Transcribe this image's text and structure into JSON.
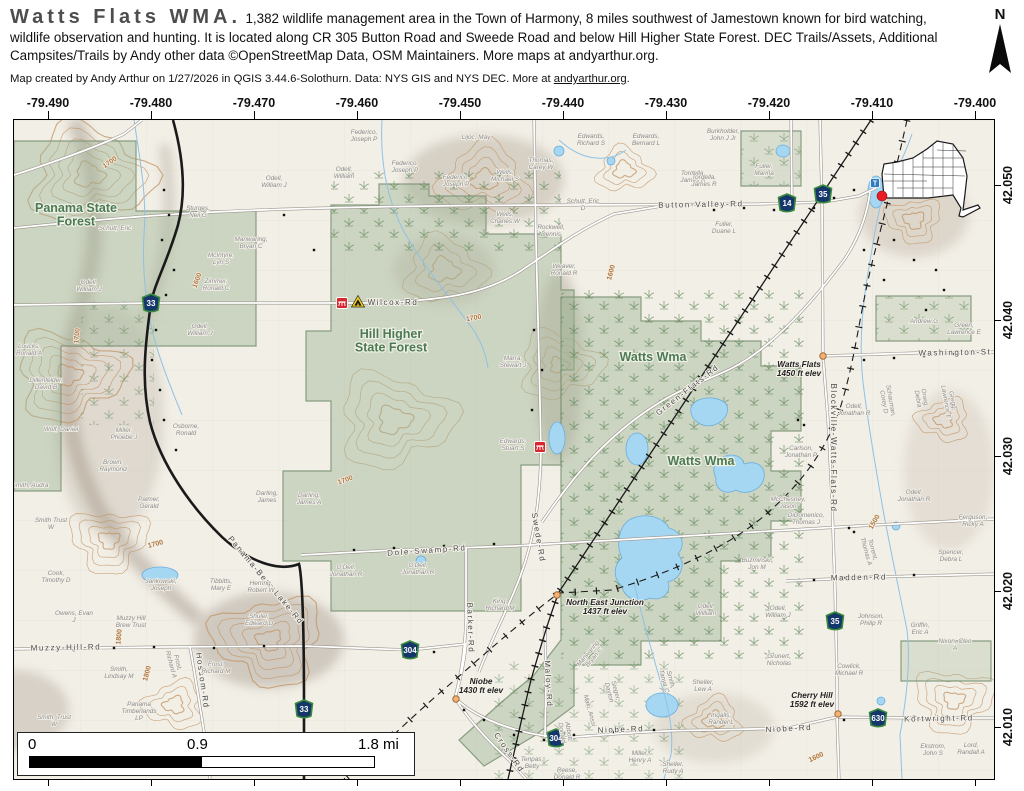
{
  "header": {
    "title": "Watts Flats WMA.",
    "description": "1,382 wildlife management area in the Town of Harmony, 8 miles southwest of Jamestown known for bird watching, wildlife observation and hunting. It is located along CR 305 Button Road and Sweede Road and below Hill Higher State Forest. DEC Trails/Assets, Additional Campsites/Trails by Andy other data ©OpenStreetMap Data, OSM Maintainers. More maps at andyarthur.org.",
    "attribution_prefix": "Map created by Andy Arthur on 1/27/2026 in QGIS 3.44.6-Solothurn. Data: NYS GIS and NYS DEC. More at ",
    "attribution_link": "andyarthur.org",
    "attribution_suffix": ".",
    "north_label": "N"
  },
  "axes": {
    "lon": [
      "-79.490",
      "-79.480",
      "-79.470",
      "-79.460",
      "-79.450",
      "-79.440",
      "-79.430",
      "-79.420",
      "-79.410",
      "-79.400"
    ],
    "lon_x": [
      35,
      138,
      241,
      344,
      447,
      550,
      653,
      756,
      859,
      962
    ],
    "lat": [
      "42.050",
      "42.040",
      "42.030",
      "42.020",
      "42.010"
    ],
    "lat_y": [
      185,
      320,
      456,
      591,
      727
    ]
  },
  "scalebar": {
    "start": "0",
    "mid": "0.9",
    "end": "1.8 mi"
  },
  "colors": {
    "forest_green": "#9db395",
    "water": "#a6d7f2",
    "contour": "#c0905f",
    "shield_fill": "#15366b",
    "shield_border": "#3a8a3c",
    "parking_red": "#d7272e",
    "campsite_yellow": "#f7d117",
    "trailhead_blue": "#2e7bbf",
    "locator_red": "#ea1c24"
  },
  "map": {
    "area_labels": [
      {
        "t": "Panama State\nForest",
        "x": 62,
        "y": 92
      },
      {
        "t": "Hill Higher\nState Forest",
        "x": 377,
        "y": 218
      },
      {
        "t": "Watts Wma",
        "x": 639,
        "y": 241
      },
      {
        "t": "Watts Wma",
        "x": 687,
        "y": 345
      }
    ],
    "road_labels": [
      {
        "t": "Wilcox-Rd",
        "x": 379,
        "y": 185,
        "r": 0
      },
      {
        "t": "Button-Valley-Rd",
        "x": 687,
        "y": 87,
        "r": -1
      },
      {
        "t": "Washington-St",
        "x": 941,
        "y": 235,
        "r": -1
      },
      {
        "t": "Green-Flats-Rd",
        "x": 675,
        "y": 272,
        "r": -38
      },
      {
        "t": "Dole-Swamp-Rd",
        "x": 413,
        "y": 433,
        "r": -4
      },
      {
        "t": "Muzzy-Hill-Rd",
        "x": 52,
        "y": 530,
        "r": -1
      },
      {
        "t": "Hossom-Rd",
        "x": 186,
        "y": 561,
        "r": 82
      },
      {
        "t": "Panama-Bear-Lake-Rd",
        "x": 250,
        "y": 462,
        "r": 50
      },
      {
        "t": "Barker-Rd",
        "x": 454,
        "y": 508,
        "r": 88
      },
      {
        "t": "Maloy-Rd",
        "x": 532,
        "y": 564,
        "r": 87
      },
      {
        "t": "Cross-Rd",
        "x": 493,
        "y": 634,
        "r": 55
      },
      {
        "t": "Swede-Rd",
        "x": 522,
        "y": 418,
        "r": 80
      },
      {
        "t": "Blockville-Watts-Flats-Rd",
        "x": 817,
        "y": 328,
        "r": 90
      },
      {
        "t": "Madden-Rd",
        "x": 845,
        "y": 460,
        "r": -1
      },
      {
        "t": "Niobe-Rd",
        "x": 607,
        "y": 612,
        "r": -2
      },
      {
        "t": "Niobe-Rd",
        "x": 775,
        "y": 611,
        "r": -3
      },
      {
        "t": "Kortwright-Rd",
        "x": 925,
        "y": 601,
        "r": -1
      }
    ],
    "contour_labels": [
      {
        "t": "1700",
        "x": 97,
        "y": 44,
        "r": -35
      },
      {
        "t": "1700",
        "x": 65,
        "y": 216,
        "r": -85
      },
      {
        "t": "1600",
        "x": 185,
        "y": 161,
        "r": -70
      },
      {
        "t": "1700",
        "x": 142,
        "y": 426,
        "r": -15
      },
      {
        "t": "1800",
        "x": 107,
        "y": 517,
        "r": -85
      },
      {
        "t": "1800",
        "x": 135,
        "y": 554,
        "r": -75
      },
      {
        "t": "1700",
        "x": 332,
        "y": 362,
        "r": -20
      },
      {
        "t": "1700",
        "x": 460,
        "y": 200,
        "r": -10
      },
      {
        "t": "1600",
        "x": 599,
        "y": 153,
        "r": -75
      },
      {
        "t": "1500",
        "x": 862,
        "y": 403,
        "r": -60
      },
      {
        "t": "1600",
        "x": 803,
        "y": 639,
        "r": -25
      }
    ],
    "elev_points": [
      {
        "t": "Watts Flats\n1450 ft elev",
        "x": 785,
        "y": 247,
        "cx": 809,
        "cy": 236
      },
      {
        "t": "North East Junction\n1437 ft elev",
        "x": 591,
        "y": 485,
        "cx": 543,
        "cy": 475
      },
      {
        "t": "Niobe\n1430 ft elev",
        "x": 467,
        "y": 564,
        "cx": 442,
        "cy": 579
      },
      {
        "t": "Cherry Hill\n1592 ft elev",
        "x": 798,
        "y": 578,
        "cx": 824,
        "cy": 594
      }
    ],
    "shields": [
      {
        "n": "33",
        "x": 137,
        "y": 183
      },
      {
        "n": "33",
        "x": 290,
        "y": 589
      },
      {
        "n": "14",
        "x": 773,
        "y": 83
      },
      {
        "n": "35",
        "x": 809,
        "y": 74
      },
      {
        "n": "35",
        "x": 821,
        "y": 501
      },
      {
        "n": "304",
        "x": 396,
        "y": 530
      },
      {
        "n": "304",
        "x": 542,
        "y": 618
      },
      {
        "n": "630",
        "x": 864,
        "y": 598
      }
    ],
    "icons": [
      {
        "type": "parking",
        "x": 328,
        "y": 183
      },
      {
        "type": "campsite",
        "x": 344,
        "y": 182
      },
      {
        "type": "parking",
        "x": 526,
        "y": 327
      },
      {
        "type": "trailhead",
        "x": 861,
        "y": 63
      },
      {
        "type": "locator-dot",
        "x": 868,
        "y": 76
      }
    ],
    "parcel_labels": [
      {
        "t": "Federico,\nJoseph P",
        "x": 350,
        "y": 14
      },
      {
        "t": "Federico,\nJoseph P",
        "x": 391,
        "y": 45
      },
      {
        "t": "Federico,\nJoseph P",
        "x": 442,
        "y": 59
      },
      {
        "t": "Lijoc, May",
        "x": 462,
        "y": 19
      },
      {
        "t": "Wells,\nMichael S",
        "x": 491,
        "y": 54
      },
      {
        "t": "Wells,\nCharles W",
        "x": 491,
        "y": 96
      },
      {
        "t": "Odell,\nWilliam",
        "x": 330,
        "y": 51
      },
      {
        "t": "Odell,\nWilliam J",
        "x": 260,
        "y": 60
      },
      {
        "t": "Sturges,\nNeil G",
        "x": 184,
        "y": 90
      },
      {
        "t": "Manwaring,\nBryan C",
        "x": 237,
        "y": 121
      },
      {
        "t": "McIntyre,\nLyn S",
        "x": 207,
        "y": 137
      },
      {
        "t": "Zimmer,\nRonald C",
        "x": 202,
        "y": 163
      },
      {
        "t": "Odell,\nWilliam J",
        "x": 186,
        "y": 208
      },
      {
        "t": "Odell,\nWilliam J",
        "x": 75,
        "y": 164
      },
      {
        "t": "Loucks,\nRonald A",
        "x": 15,
        "y": 228
      },
      {
        "t": "Dillenfelder,\nDavid B",
        "x": 32,
        "y": 262
      },
      {
        "t": "Wolf, Daniel",
        "x": 47,
        "y": 311
      },
      {
        "t": "Miller,\nPhoebe J",
        "x": 110,
        "y": 312
      },
      {
        "t": "Osborne,\nRonald",
        "x": 172,
        "y": 308
      },
      {
        "t": "Brown,\nRaymond",
        "x": 99,
        "y": 344
      },
      {
        "t": "Palmer,\nGerald",
        "x": 135,
        "y": 381
      },
      {
        "t": "Smith, Audra",
        "x": 16,
        "y": 367
      },
      {
        "t": "Smith Trust\nW",
        "x": 37,
        "y": 402
      },
      {
        "t": "Cook,\nTimothy D",
        "x": 42,
        "y": 455
      },
      {
        "t": "Owens, Evan\nJ",
        "x": 60,
        "y": 495
      },
      {
        "t": "Smith,\nLindsay M",
        "x": 105,
        "y": 551
      },
      {
        "t": "Panama\nTimberlands\nLP",
        "x": 125,
        "y": 586
      },
      {
        "t": "Smith, Trust\nW",
        "x": 40,
        "y": 599
      },
      {
        "t": "Muzzy Hill\nBrew Trust",
        "x": 117,
        "y": 500
      },
      {
        "t": "Jankowski,\nJoseph",
        "x": 147,
        "y": 463
      },
      {
        "t": "Tibbitts,\nMary E",
        "x": 207,
        "y": 463
      },
      {
        "t": "Herring,\nRobert W",
        "x": 247,
        "y": 465
      },
      {
        "t": "Shuler,\nEdward D",
        "x": 245,
        "y": 498
      },
      {
        "t": "Frost,\nRichard A",
        "x": 162,
        "y": 543,
        "r": 75
      },
      {
        "t": "Frost,\nRichard M",
        "x": 202,
        "y": 546
      },
      {
        "t": "Darling,\nJames",
        "x": 253,
        "y": 375
      },
      {
        "t": "Darling,\nJames A",
        "x": 295,
        "y": 377
      },
      {
        "t": "O'Dell,\nJonathan R",
        "x": 332,
        "y": 449
      },
      {
        "t": "O'Dell,\nJonathan R",
        "x": 404,
        "y": 447
      },
      {
        "t": "King,\nRichard M",
        "x": 486,
        "y": 483
      },
      {
        "t": "Marra,\nStewart J",
        "x": 499,
        "y": 240
      },
      {
        "t": "Edwards,\nStuart S",
        "x": 499,
        "y": 323
      },
      {
        "t": "Thomas,\nCarey W",
        "x": 527,
        "y": 42
      },
      {
        "t": "Rockwell,\nDennis",
        "x": 537,
        "y": 109
      },
      {
        "t": "Schutt, Eric\nD",
        "x": 569,
        "y": 83
      },
      {
        "t": "Weaver,\nRonald R",
        "x": 550,
        "y": 148
      },
      {
        "t": "Edwards,\nRichard S",
        "x": 577,
        "y": 18
      },
      {
        "t": "Edwards,\nBernard L",
        "x": 632,
        "y": 18
      },
      {
        "t": "Tordella,\nJames R",
        "x": 679,
        "y": 55
      },
      {
        "t": "Burkholder,\nJohn J Jr",
        "x": 709,
        "y": 13
      },
      {
        "t": "Fuller,\nMarina",
        "x": 750,
        "y": 48
      },
      {
        "t": "Fuller,\nDuane L",
        "x": 710,
        "y": 106
      },
      {
        "t": "Carlson,\nJonathan P",
        "x": 787,
        "y": 330
      },
      {
        "t": "McChesney,\nJason",
        "x": 774,
        "y": 381
      },
      {
        "t": "DiDomenico,\nThomas J",
        "x": 792,
        "y": 397
      },
      {
        "t": "Buzminski,\nJon M",
        "x": 743,
        "y": 442
      },
      {
        "t": "Odell,\nWilliam",
        "x": 692,
        "y": 488
      },
      {
        "t": "Odell,\nWilliam J",
        "x": 764,
        "y": 490
      },
      {
        "t": "Grunert,\nNicholas",
        "x": 765,
        "y": 538
      },
      {
        "t": "Manwaring,\nBryan C",
        "x": 576,
        "y": 534,
        "r": -50
      },
      {
        "t": "Smith,\nTanya C",
        "x": 655,
        "y": 560,
        "r": 75
      },
      {
        "t": "Sheller,\nLew A",
        "x": 689,
        "y": 564
      },
      {
        "t": "Ingalls,\nRandel L",
        "x": 707,
        "y": 597
      },
      {
        "t": "Maki, Anssi",
        "x": 574,
        "y": 591,
        "r": 75
      },
      {
        "t": "Sieger,\nDayton",
        "x": 600,
        "y": 571,
        "r": 75
      },
      {
        "t": "Abbott,\nDonald",
        "x": 553,
        "y": 612,
        "r": 80
      },
      {
        "t": "Tenpas,\nBetty",
        "x": 518,
        "y": 641
      },
      {
        "t": "Miller,\nHenry A",
        "x": 626,
        "y": 635
      },
      {
        "t": "Sheller,\nRudy A",
        "x": 659,
        "y": 646
      },
      {
        "t": "Reese,\nDonald R",
        "x": 553,
        "y": 652
      },
      {
        "t": "Johnson,\nPhilip R",
        "x": 857,
        "y": 498
      },
      {
        "t": "Griffin,\nEric A",
        "x": 906,
        "y": 507
      },
      {
        "t": "Nixon, Cleo\nA",
        "x": 941,
        "y": 523
      },
      {
        "t": "Cowlick,\nMichael R",
        "x": 835,
        "y": 548
      },
      {
        "t": "Ekstrom,\nJohn S",
        "x": 919,
        "y": 628
      },
      {
        "t": "Lord,\nRandall A",
        "x": 957,
        "y": 627
      },
      {
        "t": "Odell,\nJonathan R",
        "x": 840,
        "y": 288
      },
      {
        "t": "Odell,\nJonathan R",
        "x": 900,
        "y": 374
      },
      {
        "t": "Schauman,\nCorey D",
        "x": 875,
        "y": 281,
        "r": 80
      },
      {
        "t": "Orwig,\nDebra",
        "x": 909,
        "y": 278,
        "r": 80
      },
      {
        "t": "Gregg,\nLawrence E",
        "x": 937,
        "y": 281,
        "r": 80
      },
      {
        "t": "Andrew G",
        "x": 910,
        "y": 203
      },
      {
        "t": "Green,\nLawrence E",
        "x": 950,
        "y": 207
      },
      {
        "t": "Torrent,\nThomas A",
        "x": 857,
        "y": 430,
        "r": 75
      },
      {
        "t": "Spencer,\nDebra L",
        "x": 937,
        "y": 434
      },
      {
        "t": "Ferguson,\nRicky A",
        "x": 959,
        "y": 399
      },
      {
        "t": "Schutt, Eric",
        "x": 101,
        "y": 110
      },
      {
        "t": "Tordella,\nJames R",
        "x": 690,
        "y": 59
      }
    ]
  }
}
